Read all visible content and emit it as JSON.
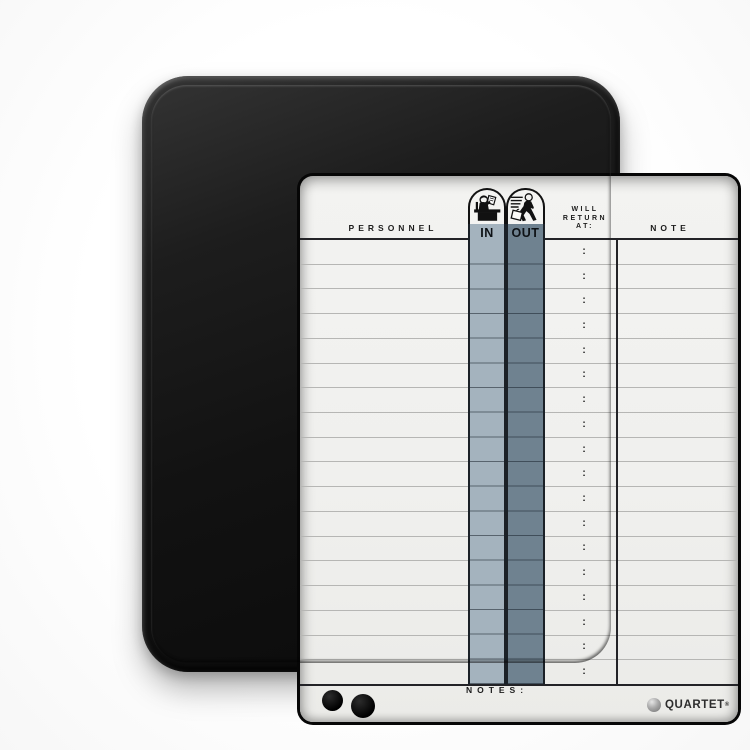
{
  "board": {
    "headers": {
      "personnel": "PERSONNEL",
      "in": "IN",
      "out": "OUT",
      "will_return": [
        "WILL",
        "RETURN",
        "AT:"
      ],
      "note": "NOTE"
    },
    "rows": {
      "count": 18,
      "time_separator": ":"
    },
    "footer": {
      "notes_label": "NOTES:",
      "brand": "QUARTET",
      "brand_mark": "®"
    },
    "icons": {
      "in_icon": "person-at-desk-icon",
      "out_icon": "person-leaving-with-briefcase-icon",
      "logo_icon": "quartet-sphere-icon"
    },
    "magnets": {
      "count": 2,
      "color": "#0b0b0b"
    },
    "colors": {
      "frame": "#141414",
      "surface": "#f1f1ef",
      "in_band": "#a4b3be",
      "out_band": "#6f8290",
      "row_line": "#b6b6b4",
      "grid_dark": "#232327",
      "text": "#1c1c1c"
    }
  }
}
